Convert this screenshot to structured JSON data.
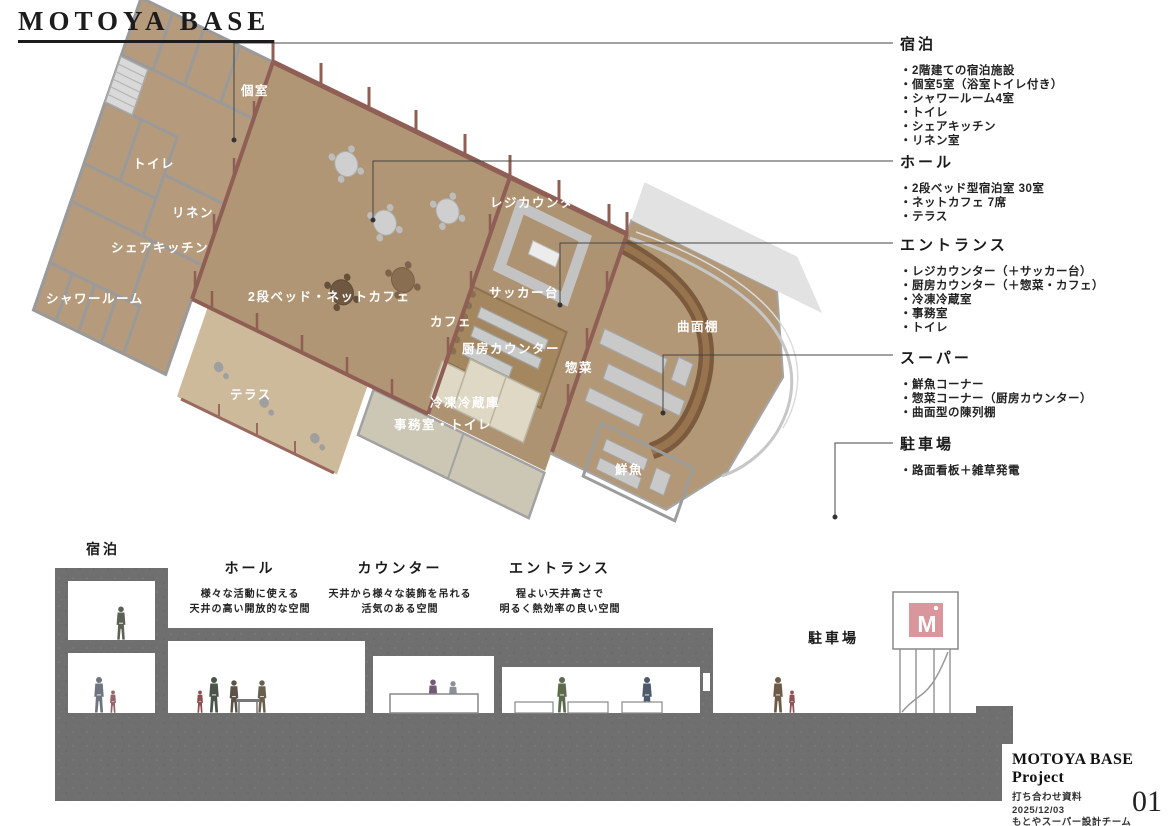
{
  "title": "MOTOYA BASE",
  "plan_labels": {
    "private_room": "個室",
    "toilet": "トイレ",
    "linen": "リネン",
    "share_kitchen": "シェアキッチン",
    "shower_room": "シャワールーム",
    "bunk_net_cafe": "2段ベッド・ネットカフェ",
    "terrace": "テラス",
    "register_counter": "レジカウンター",
    "bagging_table": "サッカー台",
    "cafe": "カフェ",
    "kitchen_counter": "厨房カウンター",
    "freezer_fridge": "冷凍冷蔵庫",
    "office_toilet": "事務室・トイレ",
    "deli": "惣菜",
    "curved_shelf": "曲面棚",
    "fresh_fish": "鮮魚"
  },
  "annotations": [
    {
      "heading": "宿泊",
      "items": [
        "・2階建ての宿泊施設",
        "・個室5室（浴室トイレ付き）",
        "・シャワールーム4室",
        "・トイレ",
        "・シェアキッチン",
        "・リネン室"
      ]
    },
    {
      "heading": "ホール",
      "items": [
        "・2段ベッド型宿泊室 30室",
        "・ネットカフェ 7席",
        "・テラス"
      ]
    },
    {
      "heading": "エントランス",
      "items": [
        "・レジカウンター（＋サッカー台）",
        "・厨房カウンター（＋惣菜・カフェ）",
        "・冷凍冷蔵室",
        "・事務室",
        "・トイレ"
      ]
    },
    {
      "heading": "スーパー",
      "items": [
        "・鮮魚コーナー",
        "・惣菜コーナー（厨房カウンター）",
        "・曲面型の陳列棚"
      ]
    },
    {
      "heading": "駐車場",
      "items": [
        "・路面看板＋雑草発電"
      ]
    }
  ],
  "section_labels": [
    {
      "heading": "宿泊",
      "desc": []
    },
    {
      "heading": "ホール",
      "desc": [
        "様々な活動に使える",
        "天井の高い開放的な空間"
      ]
    },
    {
      "heading": "カウンター",
      "desc": [
        "天井から様々な装飾を吊れる",
        "活気のある空間"
      ]
    },
    {
      "heading": "エントランス",
      "desc": [
        "程よい天井高さで",
        "明るく熱効率の良い空間"
      ]
    },
    {
      "heading": "駐車場",
      "desc": []
    }
  ],
  "title_block": {
    "project": "MOTOYA BASE Project",
    "doc_type": "打ち合わせ資料",
    "date": "2025/12/03",
    "team": "もとやスーパー設計チーム",
    "page": "01"
  },
  "logo": {
    "letter": "M"
  },
  "colors": {
    "floor_tan": "#b09674",
    "terrace_tan": "#ccba9b",
    "wood_rose": "#8f5f55",
    "shelf_brown": "#7b5a3e",
    "ground_gray": "#6f6f6f",
    "logo_pink": "#d9969c"
  }
}
